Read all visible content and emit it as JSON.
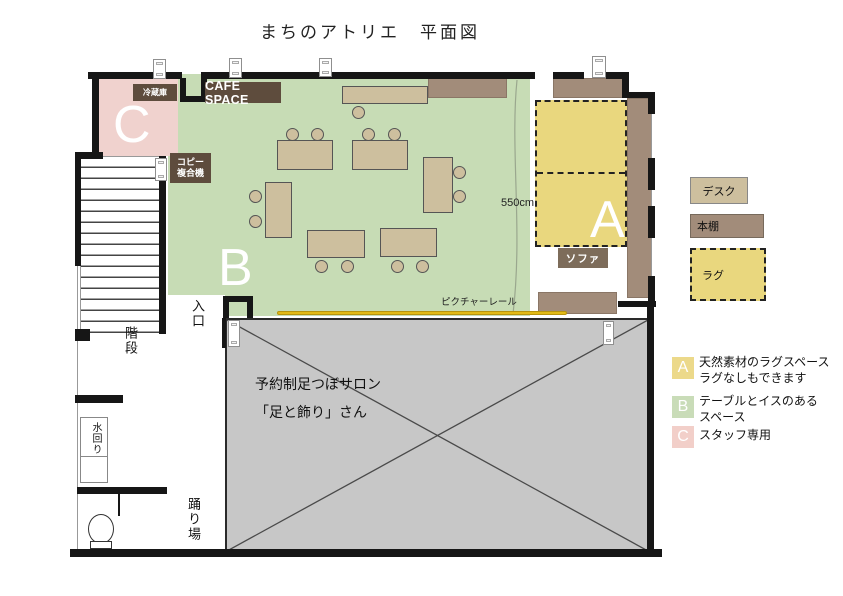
{
  "title": "まちのアトリエ　平面図",
  "plan": {
    "cafe_space": "CAFE SPACE",
    "fridge": "冷蔵庫",
    "copier_line1": "コピー",
    "copier_line2": "複合機",
    "sofa": "ソファ",
    "dimension": "550cm",
    "picture_rail": "ピクチャーレール",
    "salon_line1": "予約制足つぼサロン",
    "salon_line2": "「足と飾り」さん",
    "entrance": "入口",
    "stairs": "階段",
    "water_area": "水回り",
    "landing": "踊り場",
    "zone_a": "A",
    "zone_b": "B",
    "zone_c": "C"
  },
  "legend": {
    "desk": "デスク",
    "bookshelf": "本棚",
    "rug": "ラグ"
  },
  "key": [
    {
      "letter": "A",
      "line1": "天然素材のラグスペース",
      "line2": "ラグなしもできます"
    },
    {
      "letter": "B",
      "line1": "テーブルとイスのある",
      "line2": "スペース"
    },
    {
      "letter": "C",
      "line1": "スタッフ専用",
      "line2": ""
    }
  ],
  "colors": {
    "zone_a_rug": "#e9d77e",
    "zone_b_green": "#c7dcb5",
    "zone_c_pink": "#f0d2ce",
    "desk_tan": "#cdbf9e",
    "bookshelf_brown": "#a28c7a",
    "label_brown": "#5e4c3d",
    "sofa_brown": "#7d6c5a",
    "salon_gray": "#c7c7c7",
    "picture_rail_yellow": "#e2ba16",
    "wall_black": "#161616"
  }
}
